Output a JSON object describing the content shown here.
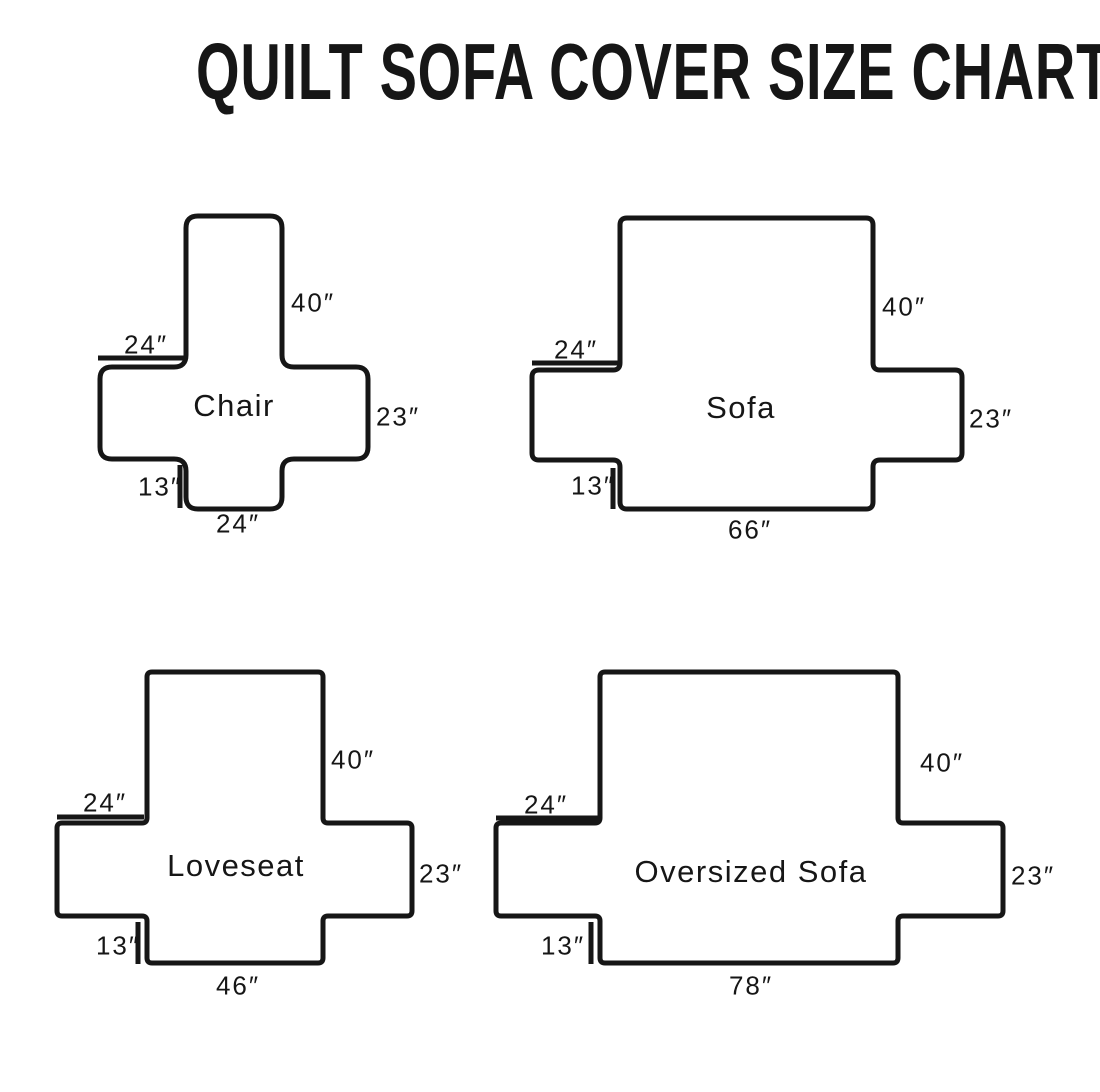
{
  "title": "QUILT SOFA COVER SIZE CHART",
  "colors": {
    "ink": "#161616",
    "background": "#ffffff"
  },
  "figures": [
    {
      "name": "Chair",
      "dims": {
        "back_height": "40″",
        "arm_width": "24″",
        "arm_height": "23″",
        "front_drop": "13″",
        "seat_width": "24″"
      },
      "geometry": {
        "vbar": [
          186,
          216,
          96,
          293
        ],
        "hbar": [
          100,
          367,
          268,
          92
        ],
        "corner_radius": 12,
        "arm_tick": [
          98,
          358,
          184,
          358
        ],
        "front_tick": [
          180,
          465,
          180,
          508
        ]
      }
    },
    {
      "name": "Sofa",
      "dims": {
        "back_height": "40″",
        "arm_width": "24″",
        "arm_height": "23″",
        "front_drop": "13″",
        "seat_width": "66″"
      },
      "geometry": {
        "vbar": [
          620,
          218,
          253,
          291
        ],
        "hbar": [
          532,
          370,
          430,
          90
        ],
        "corner_radius": 7,
        "arm_tick": [
          532,
          363,
          618,
          363
        ],
        "front_tick": [
          613,
          468,
          613,
          509
        ]
      }
    },
    {
      "name": "Loveseat",
      "dims": {
        "back_height": "40″",
        "arm_width": "24″",
        "arm_height": "23″",
        "front_drop": "13″",
        "seat_width": "46″"
      },
      "geometry": {
        "vbar": [
          147,
          672,
          176,
          291
        ],
        "hbar": [
          57,
          823,
          355,
          93
        ],
        "corner_radius": 5,
        "arm_tick": [
          57,
          817,
          144,
          817
        ],
        "front_tick": [
          138,
          922,
          138,
          964
        ]
      }
    },
    {
      "name": "Oversized Sofa",
      "dims": {
        "back_height": "40″",
        "arm_width": "24″",
        "arm_height": "23″",
        "front_drop": "13″",
        "seat_width": "78″"
      },
      "geometry": {
        "vbar": [
          600,
          672,
          298,
          291
        ],
        "hbar": [
          496,
          823,
          507,
          93
        ],
        "corner_radius": 5,
        "arm_tick": [
          496,
          818,
          598,
          818
        ],
        "front_tick": [
          591,
          922,
          591,
          964
        ]
      }
    }
  ]
}
